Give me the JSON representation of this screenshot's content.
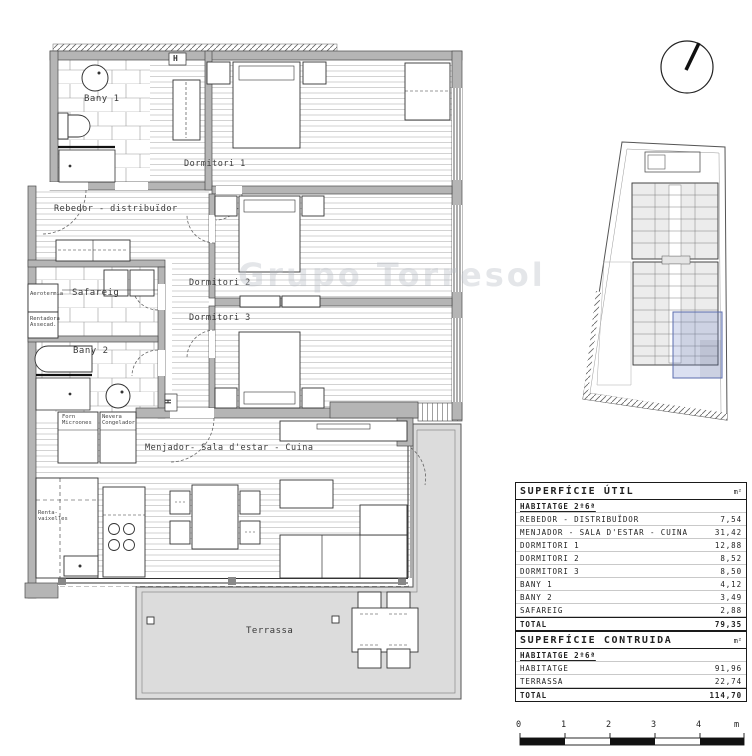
{
  "watermark": "Grupo Torresol",
  "plan": {
    "rooms": {
      "bany1": "Bany 1",
      "dormitori1": "Dormitori 1",
      "rebedor": "Rebedor - distribuïdor",
      "dormitori2": "Dormitori 2",
      "dormitori3": "Dormitori 3",
      "safareig": "Safareig",
      "bany2": "Bany 2",
      "menjador": "Menjador- Sala d'estar - Cuina",
      "terrassa": "Terrassa"
    },
    "labels": {
      "aerotermia": "Aerotermia",
      "rentadora_assecadora": "Rentadora Assecad.",
      "forn_microones": "Forn Microones",
      "nevera_congelador": "Nevera Congelador",
      "rentavaixelles": "Renta- vaixelles",
      "column_marker": "H"
    }
  },
  "area_table": {
    "sections": [
      {
        "title": "SUPERFÍCIE ÚTIL",
        "unit": "m²",
        "group": "HABITATGE 2º6ª",
        "rows": [
          {
            "label": "REBEDOR - DISTRIBUÏDOR",
            "value": "7,54"
          },
          {
            "label": "MENJADOR - SALA D'ESTAR - CUINA",
            "value": "31,42"
          },
          {
            "label": "DORMITORI 1",
            "value": "12,88"
          },
          {
            "label": "DORMITORI 2",
            "value": "8,52"
          },
          {
            "label": "DORMITORI 3",
            "value": "8,50"
          },
          {
            "label": "BANY 1",
            "value": "4,12"
          },
          {
            "label": "BANY 2",
            "value": "3,49"
          },
          {
            "label": "SAFAREIG",
            "value": "2,88"
          }
        ],
        "total_label": "TOTAL",
        "total": "79,35"
      },
      {
        "title": "SUPERFÍCIE CONTRUIDA",
        "unit": "m²",
        "group": "HABITATGE 2º6ª",
        "rows": [
          {
            "label": "HABITATGE",
            "value": "91,96"
          },
          {
            "label": "TERRASSA",
            "value": "22,74"
          }
        ],
        "total_label": "TOTAL",
        "total": "114,70"
      }
    ]
  },
  "scale_bar": {
    "ticks": [
      "0",
      "1",
      "2",
      "3",
      "4"
    ],
    "unit": "m"
  },
  "colors": {
    "wall": "#b5b5b5",
    "terrace": "#dcdcdc",
    "highlight": "#5b6dae"
  }
}
